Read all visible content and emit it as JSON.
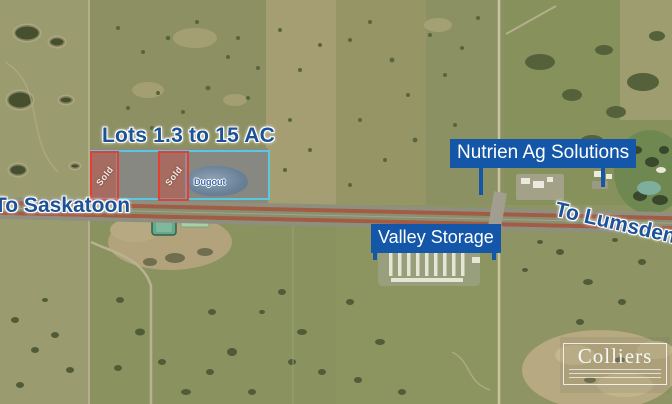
{
  "map_title": "Aerial lot map - highway commercial land listing",
  "annotations": {
    "lots_label": "Lots 1.3 to 15 AC",
    "nutrien_label": "Nutrien Ag Solutions",
    "valley_label": "Valley Storage",
    "to_saskatoon": "To Saskatoon",
    "to_lumsden": "To Lumsden",
    "parcels": {
      "sold_left": "Sold",
      "sold_right": "Sold",
      "dugout": "Dugout"
    }
  },
  "branding": {
    "logo_text": "Colliers"
  },
  "colors": {
    "callout_box_blue": "#1457a8",
    "halo_text_blue": "#1d5296",
    "sold_parcel_red": "#e43e2f",
    "available_parcel_cyan": "#58c9e4",
    "highway_red_brown": "#a25b45",
    "lagoon_teal": "#64a98d"
  }
}
